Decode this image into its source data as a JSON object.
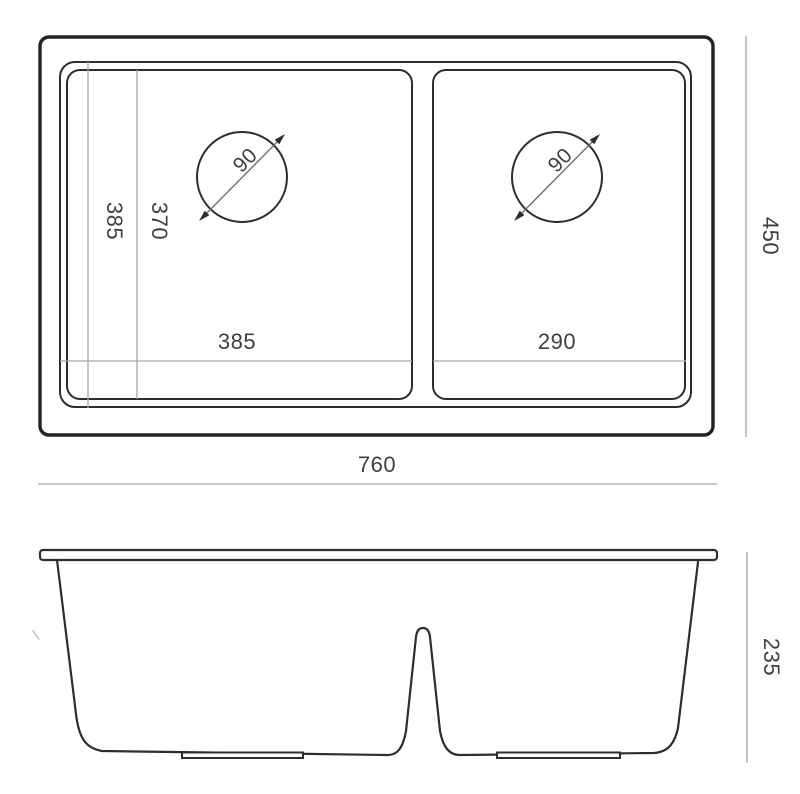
{
  "labels": {
    "top_view": {
      "left_bowl_width": "385",
      "right_bowl_width": "290",
      "rim_depth": "385",
      "bowl_depth": "370",
      "left_drain_diameter": "90",
      "right_drain_diameter": "90",
      "overall_width": "760",
      "overall_depth": "450"
    },
    "side_view": {
      "overall_height": "235"
    }
  },
  "colors": {
    "background": "#ffffff",
    "outline": "#2d2d2d",
    "outline_heavy": "#222222",
    "dim_line": "#a6a6a6",
    "dim_text": "#3f3f3f",
    "drain_line": "#6f6f6f"
  }
}
